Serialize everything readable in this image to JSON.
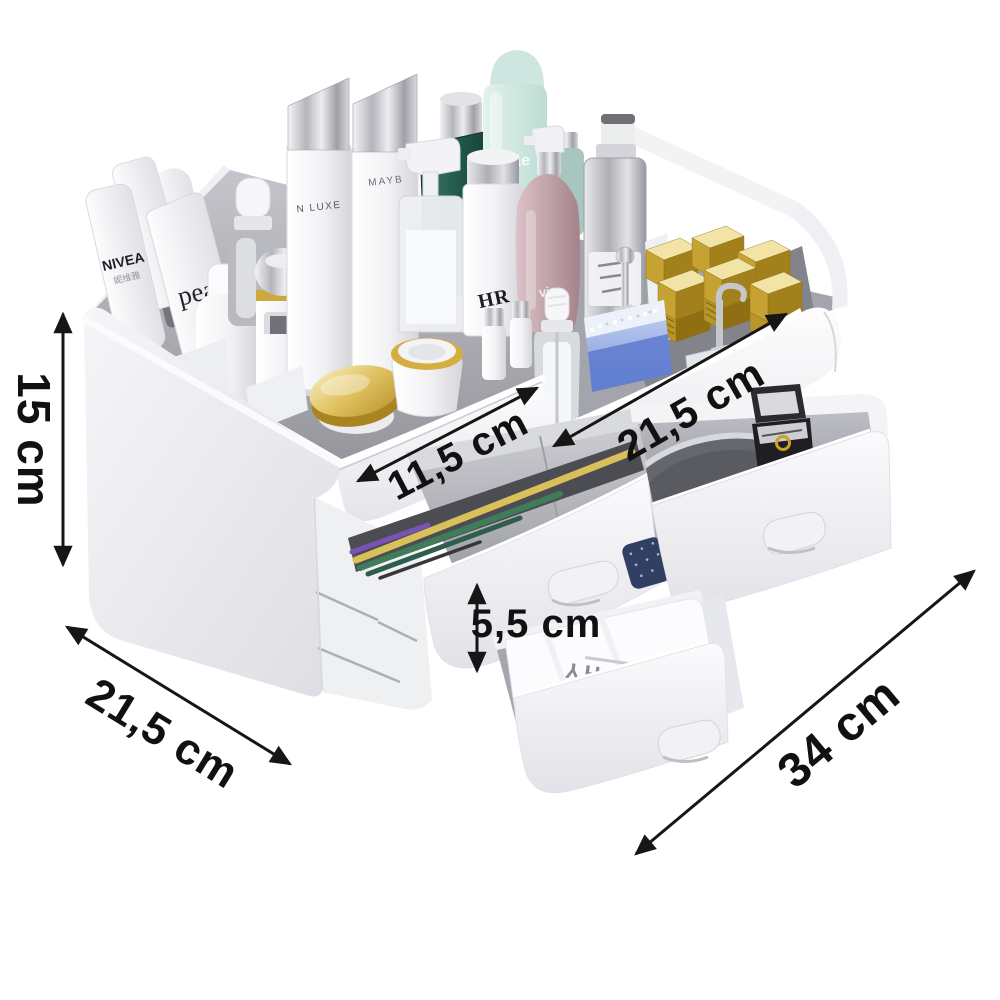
{
  "dimensions": {
    "height": "15 cm",
    "depth": "21,5 cm",
    "small_tray_width": "11,5 cm",
    "large_tray_width": "21,5 cm",
    "drawer_height": "5,5 cm",
    "total_width": "34 cm"
  },
  "brands": {
    "nivea": "NIVEA",
    "nivea_cn": "妮维雅",
    "pearl_tube": "pea",
    "bottle_n_luxe": "N LUXE",
    "bottle_mayb": "MAYB",
    "mint_can": "vie",
    "hr_bottle": "HR",
    "pink_bottle": "vie",
    "vichy_box": "VICHY"
  },
  "colors": {
    "background": "#ffffff",
    "annotation": "#161616",
    "body": "#f2f2f5",
    "tray_interior": "#a6a7ae",
    "gold": "#d4af37",
    "green_bottle": "#1f5448",
    "mint": "#cfe6df",
    "perfume_blue": "#6f8cd8",
    "pink": "#c4a0a6",
    "silver": "#b9bac1"
  }
}
